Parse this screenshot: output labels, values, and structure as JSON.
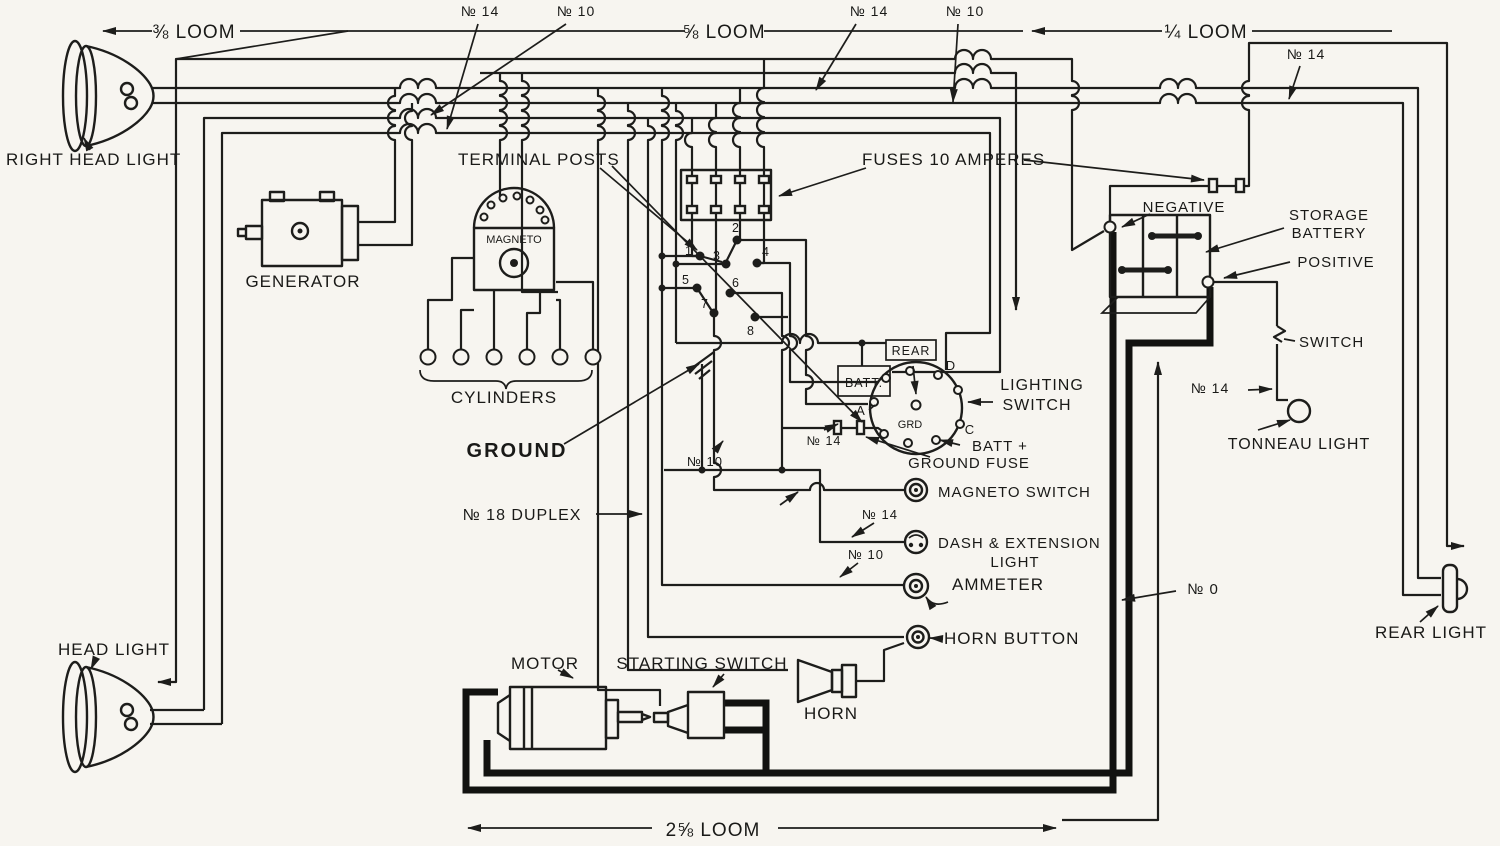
{
  "page": {
    "background": "#f7f5f0",
    "ink": "#1d1d1b"
  },
  "labels": {
    "right_head_light": "RIGHT HEAD LIGHT",
    "head_light": "HEAD LIGHT",
    "generator": "GENERATOR",
    "magneto": "MAGNETO",
    "cylinders": "CYLINDERS",
    "terminal_posts": "TERMINAL POSTS",
    "fuses": "FUSES 10 AMPERES",
    "ground": "GROUND",
    "no18_duplex": "№ 18 DUPLEX",
    "loom_38": "⅜ LOOM",
    "loom_58": "⅝ LOOM",
    "loom_14": "¼ LOOM",
    "loom_258": "2⅝ LOOM",
    "no14": "№ 14",
    "no10": "№ 10",
    "no0": "№ 0",
    "lighting": "LIGHTING",
    "switch_word": "SWITCH",
    "batt_plus": "BATT +",
    "ground_fuse": "GROUND FUSE",
    "magneto_switch": "MAGNETO SWITCH",
    "dash_extension": "DASH & EXTENSION",
    "light_word": "LIGHT",
    "ammeter": "AMMETER",
    "horn_button": "HORN BUTTON",
    "horn": "HORN",
    "motor": "MOTOR",
    "starting_switch": "STARTING SWITCH",
    "storage": "STORAGE",
    "battery": "BATTERY",
    "negative": "NEGATIVE",
    "positive": "POSITIVE",
    "tonneau_light": "TONNEAU LIGHT",
    "rear_light": "REAR LIGHT",
    "rear": "REAR",
    "batt": "BATT.",
    "grd": "GRD",
    "term_a": "A",
    "term_c": "C",
    "term_d": "D",
    "posts": [
      "1",
      "2",
      "3",
      "4",
      "5",
      "6",
      "7",
      "8"
    ]
  }
}
